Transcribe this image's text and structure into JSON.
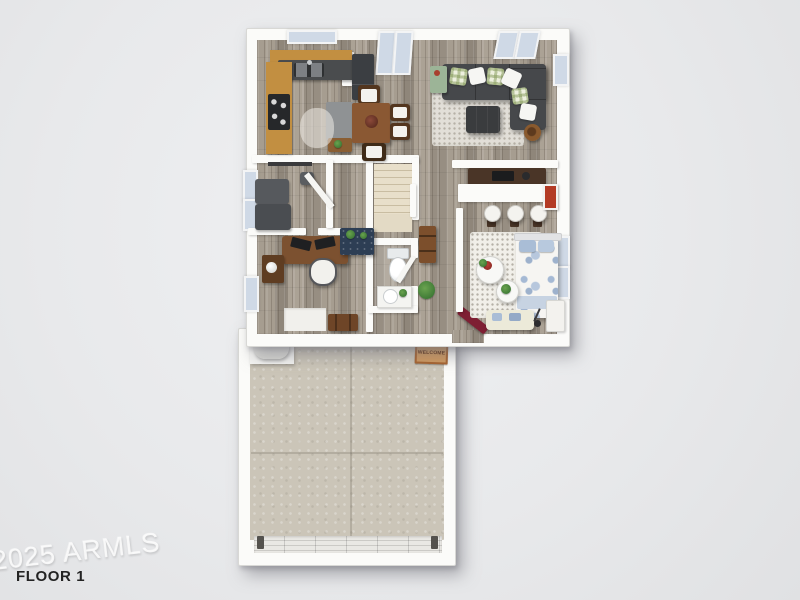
{
  "labels": {
    "floor": "FLOOR 1",
    "watermark": "2025 ARMLS",
    "welcome_mat": "WELCOME"
  },
  "colors": {
    "background": "#e8e9eb",
    "wall": "#fbfbf9",
    "wood_floor": "#9d9488",
    "garage_floor": "#cbc5b8",
    "stairs": "#e0d5bf",
    "cabinet_wood": "#c28f41",
    "counter_dark": "#4a4c4e",
    "island_gray": "#8f9294",
    "table_brown": "#8a5833",
    "sofa_gray": "#46484b",
    "ottoman_dark": "#3a3c3e",
    "navy_cabinet": "#2d3e54",
    "rug_living": "#e2dfd8",
    "rug_bedroom": "#f1efe9",
    "bed_blue": "#a9bdd6",
    "accent_red_runner": "#7e1f33",
    "wall_art_red": "#b33b25",
    "mat_orange": "#d29a5f",
    "window_glass": "#cfd9e6",
    "appliance_dark": "#3b3e42"
  }
}
